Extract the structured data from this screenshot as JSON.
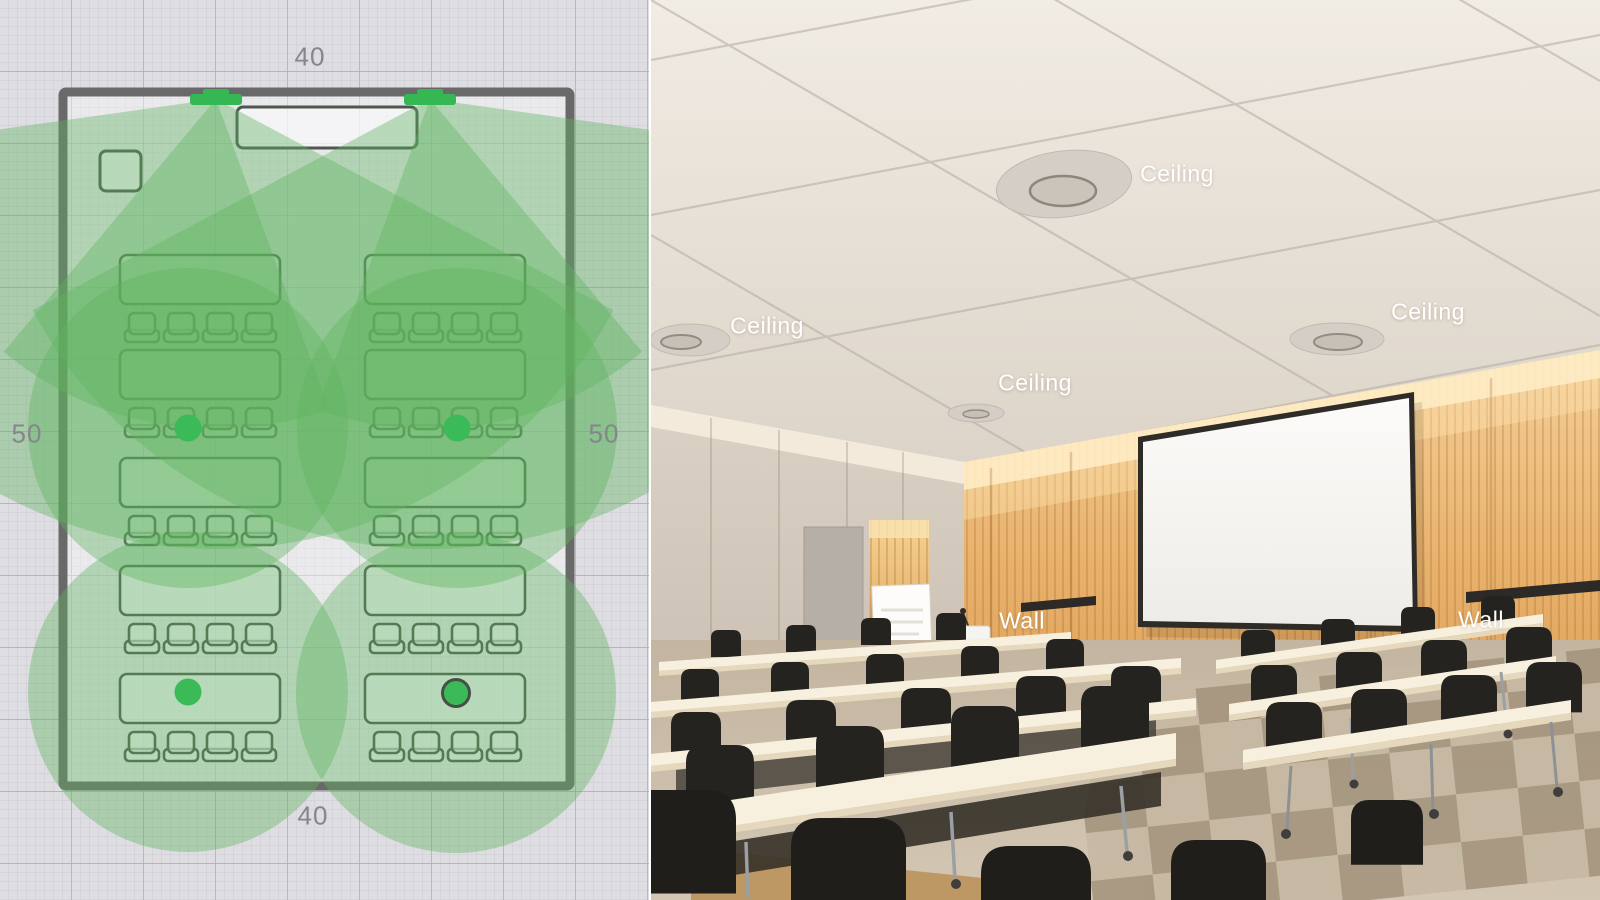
{
  "floor_plan": {
    "dimension_labels": {
      "top": "40",
      "bottom": "40",
      "left": "50",
      "right": "50"
    },
    "devices": {
      "wall_microphones": [
        {
          "icon": "wall-mic-bar"
        },
        {
          "icon": "wall-mic-bar"
        }
      ],
      "ceiling_microphones": [
        {
          "icon": "mic-coverage-dot",
          "selected": false
        },
        {
          "icon": "mic-coverage-dot",
          "selected": false
        },
        {
          "icon": "mic-coverage-dot",
          "selected": false
        },
        {
          "icon": "mic-coverage-dot",
          "selected": true
        }
      ]
    },
    "colors": {
      "coverage": "#5fb35f",
      "device_green": "#35b754",
      "selected_outline": "#454f47",
      "wall_gray": "#696969",
      "grid_background": "#dedde2"
    }
  },
  "photo_panel": {
    "description": "Conference room photo with labeled microphone mounting positions",
    "labels": [
      {
        "text": "Ceiling"
      },
      {
        "text": "Ceiling"
      },
      {
        "text": "Ceiling"
      },
      {
        "text": "Ceiling"
      },
      {
        "text": "Wall"
      },
      {
        "text": "Wall"
      }
    ]
  }
}
